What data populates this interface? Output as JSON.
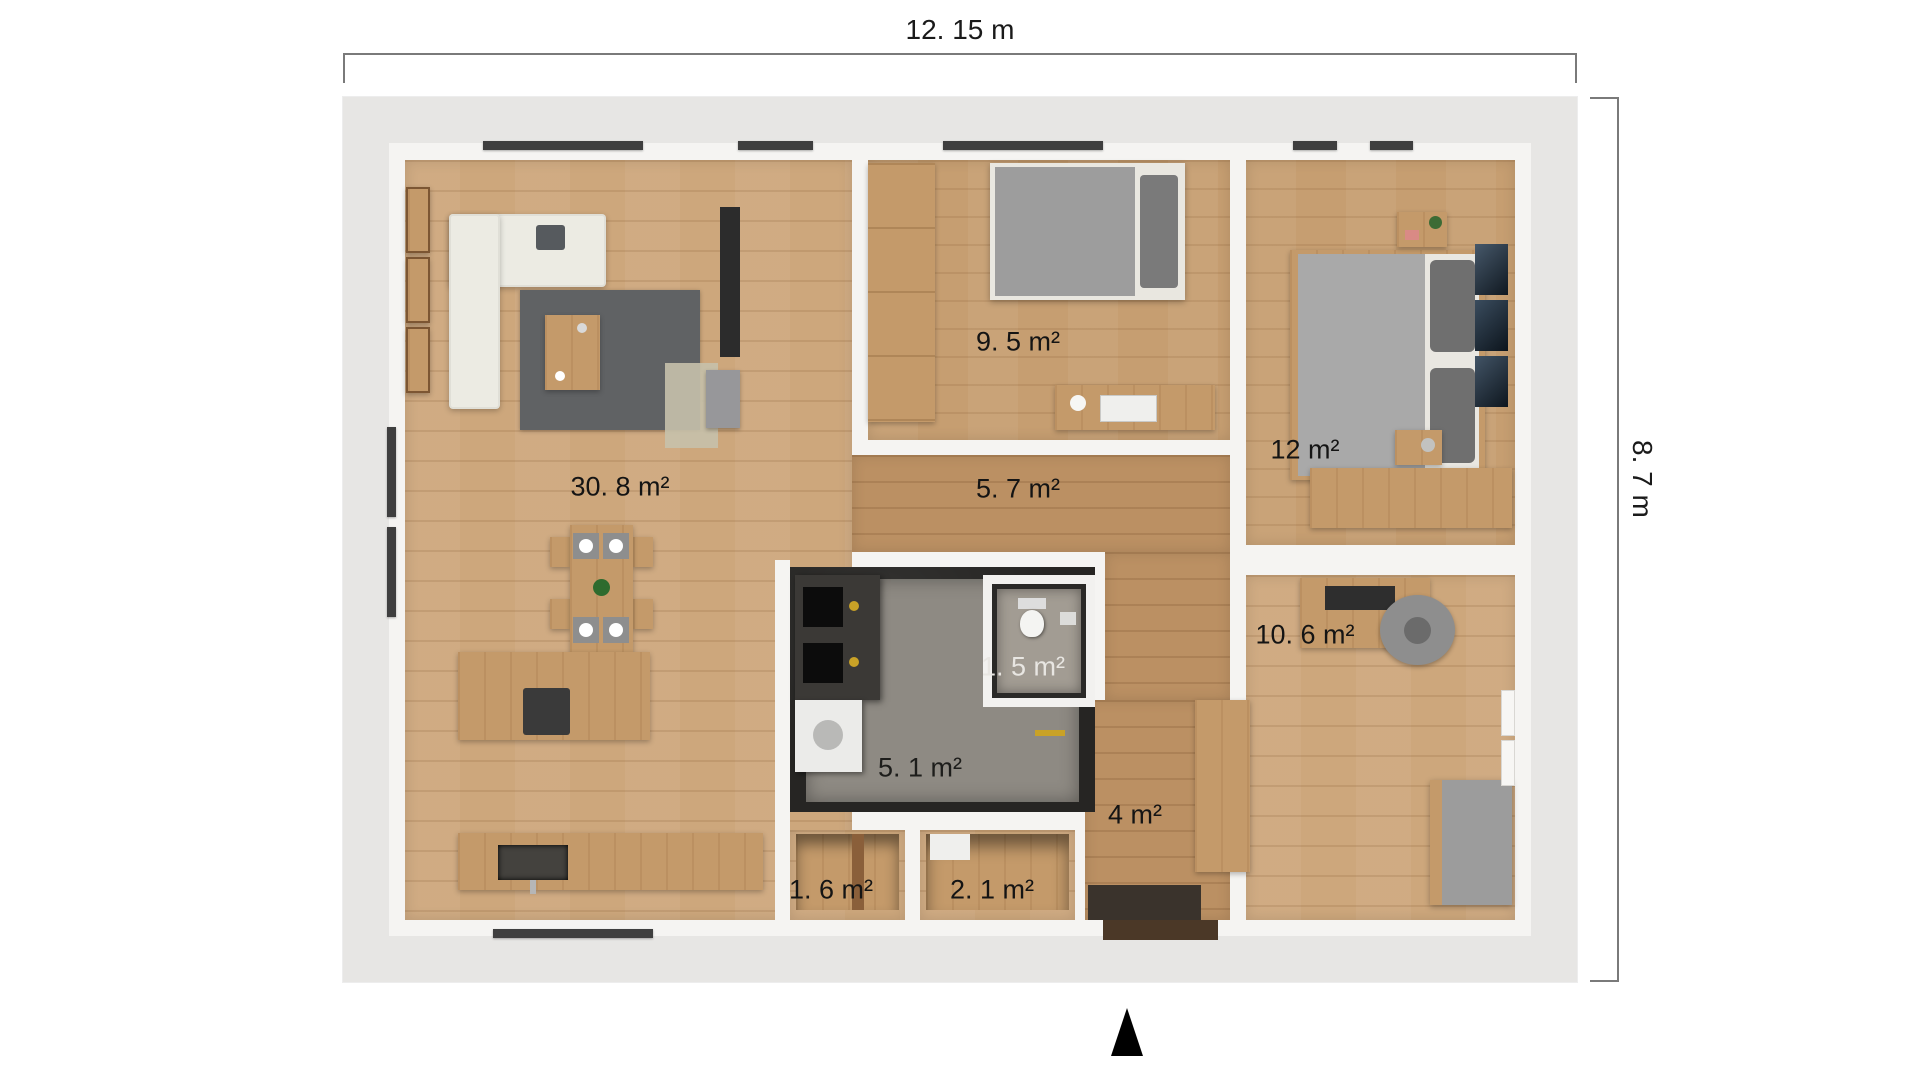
{
  "dimensions": {
    "width_label": "12. 15 m",
    "height_label": "8. 7 m"
  },
  "rooms": [
    {
      "name": "living-room-kitchen",
      "area_label": "30. 8 m²"
    },
    {
      "name": "bedroom-small",
      "area_label": "9. 5 m²"
    },
    {
      "name": "hallway",
      "area_label": "5. 7 m²"
    },
    {
      "name": "bedroom-master",
      "area_label": "12 m²"
    },
    {
      "name": "wc",
      "area_label": "1. 5 m²"
    },
    {
      "name": "bedroom-office",
      "area_label": "10. 6 m²"
    },
    {
      "name": "bathroom",
      "area_label": "5. 1 m²"
    },
    {
      "name": "entry-hall",
      "area_label": "4 m²"
    },
    {
      "name": "storage-small",
      "area_label": "1. 6 m²"
    },
    {
      "name": "storage-large",
      "area_label": "2. 1 m²"
    }
  ],
  "compass": {
    "icon": "north-arrow"
  },
  "colors": {
    "exterior_wall": "#e7e6e4",
    "interior_wall": "#f5f4f2",
    "wood_floor": "#cda77c",
    "wood_floor_dark": "#bb9063",
    "bathroom_wall": "#262523",
    "bathroom_floor": "#8e8a83",
    "dimension_line": "#7a7a7a",
    "label_text": "#141414",
    "gold_fixture": "#c9a227"
  }
}
